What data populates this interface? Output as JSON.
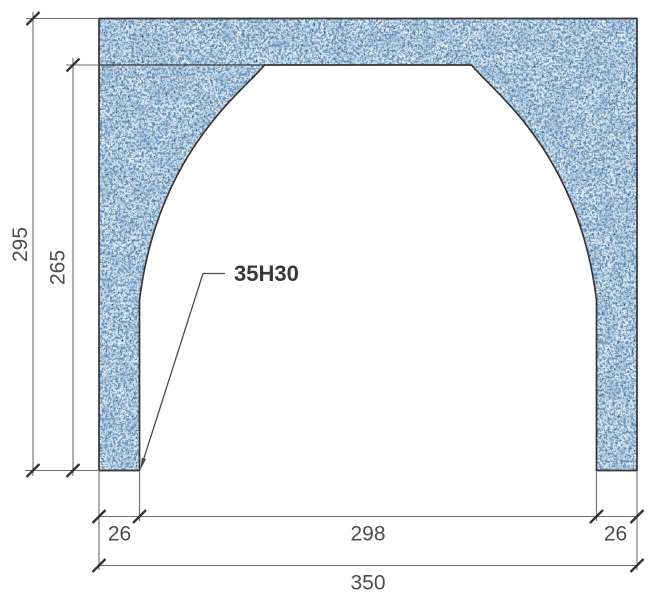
{
  "drawing": {
    "callout": {
      "label": "35H30"
    },
    "dimensions": {
      "overall_height": "295",
      "opening_height": "265",
      "left_jamb_width": "26",
      "opening_width": "298",
      "right_jamb_width": "26",
      "overall_width": "350"
    },
    "colors": {
      "background": "#ffffff",
      "outline": "#353535",
      "dimension_lines": "#6e6e6e",
      "dimension_text": "#4d4d4d",
      "callout_text": "#383838",
      "material_base": "#edf2f6",
      "material_speckle_light": "#b8cee1",
      "material_speckle_mid": "#6b99c4",
      "material_speckle_fine": "#5485b5",
      "material_speckle_dark": "#1f4060"
    }
  }
}
